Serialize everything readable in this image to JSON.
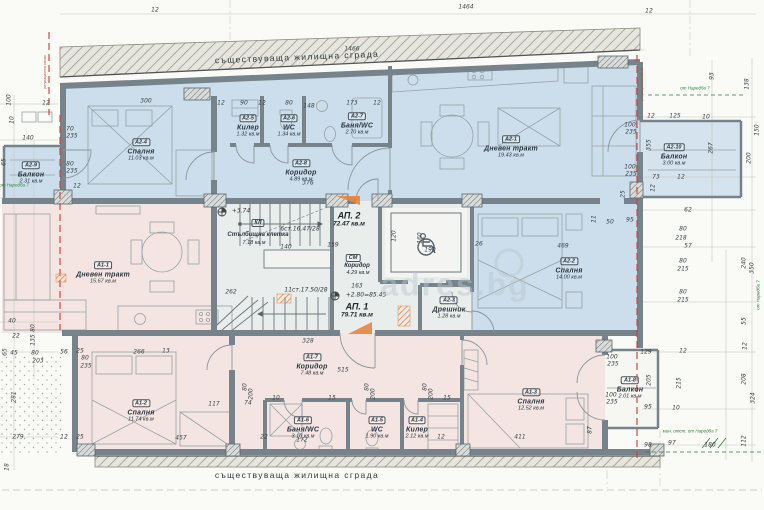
{
  "colors": {
    "ap2_fill": "#ccdeeb",
    "ap1_fill": "#f4e5e3",
    "common_fill": "#e9edec",
    "wall": "#76838a",
    "red": "#d23b2f",
    "green": "#2f7d3a",
    "orange": "#e8833f",
    "dim_text": "#3d4448",
    "paper": "#fafaf7"
  },
  "strips": {
    "top": "съществуваща жилищна сграда",
    "bottom": "съществуваща жилищна сграда"
  },
  "watermark": {
    "text": "adres.bg"
  },
  "apartments": [
    {
      "label": "АП. 2",
      "area": "72.47 кв.м",
      "x": 349,
      "y": 219
    },
    {
      "label": "АП. 1",
      "area": "79.71 кв.м",
      "x": 357,
      "y": 310
    }
  ],
  "rooms": [
    {
      "code": "А2-1",
      "name": "Дневен тракт",
      "area": "19.43 кв.м",
      "x": 511,
      "y": 143
    },
    {
      "code": "А2-2",
      "name": "Спалня",
      "area": "14.00 кв.м",
      "x": 569,
      "y": 265
    },
    {
      "code": "А2-3",
      "name": "Дрешник",
      "area": "1.28 кв.м",
      "x": 449,
      "y": 304
    },
    {
      "code": "А2-4",
      "name": "Спалня",
      "area": "11.03 кв.м",
      "x": 141,
      "y": 146
    },
    {
      "code": "А2-5",
      "name": "Килер",
      "area": "1.32 кв.м",
      "x": 248,
      "y": 122
    },
    {
      "code": "А2-6",
      "name": "WC",
      "area": "1.34 кв.м",
      "x": 289,
      "y": 122
    },
    {
      "code": "А2-7",
      "name": "Баня/WC",
      "area": "2.70 кв.м",
      "x": 357,
      "y": 120
    },
    {
      "code": "А2-8",
      "name": "Коридор",
      "area": "4.89 кв.м",
      "x": 301,
      "y": 167
    },
    {
      "code": "А2-9",
      "name": "Балкон",
      "area": "2.31 кв.м",
      "x": 31,
      "y": 169
    },
    {
      "code": "А2-10",
      "name": "Балкон",
      "area": "3.00 кв.м",
      "x": 674,
      "y": 151
    },
    {
      "code": "А1-1",
      "name": "Дневен тракт",
      "area": "15.67 кв.м",
      "x": 103,
      "y": 269
    },
    {
      "code": "А1-2",
      "name": "Спалня",
      "area": "11.74 кв.м",
      "x": 141,
      "y": 407
    },
    {
      "code": "А1-3",
      "name": "Спалня",
      "area": "12.52 кв.м",
      "x": 531,
      "y": 396
    },
    {
      "code": "А1-4",
      "name": "Килер",
      "area": "2.12 кв.м",
      "x": 417,
      "y": 424
    },
    {
      "code": "А1-5",
      "name": "WC",
      "area": "1.90 кв.м",
      "x": 377,
      "y": 424
    },
    {
      "code": "А1-6",
      "name": "Баня/WC",
      "area": "3.10 кв.м",
      "x": 303,
      "y": 424
    },
    {
      "code": "А1-7",
      "name": "Коридор",
      "area": "7.48 кв.м",
      "x": 312,
      "y": 361
    },
    {
      "code": "А1-8",
      "name": "Балкон",
      "area": "2.01 кв.м",
      "x": 630,
      "y": 384
    }
  ],
  "stairwell": {
    "code": "КЛ",
    "name": "Стълбищна клетка",
    "area": "7.18 кв.м",
    "flight_up": "6ст.16.47/28",
    "flight_down": "11ст.17.50/28",
    "level_landing": "+3.74"
  },
  "common_corridor": {
    "code": "СМ",
    "name": "Коридор",
    "area": "4.29 кв.м"
  },
  "levels": {
    "main": "+2.80=85.45"
  },
  "green_notes": [
    {
      "t": "от Наредба 7",
      "x": 695,
      "y": 88
    },
    {
      "t": "от Наредба 7",
      "x": 14,
      "y": 185
    },
    {
      "t": "мин. отст. от Наредба 7",
      "x": 690,
      "y": 431
    },
    {
      "t": "от Наредба 7",
      "x": 758,
      "y": 295,
      "r": -90
    }
  ],
  "red_notes": [
    {
      "t": "регулационна линия",
      "x": 45,
      "y": 72,
      "r": -90
    },
    {
      "t": "регулационна линия",
      "x": 642,
      "y": 84,
      "r": -90
    }
  ],
  "dimensions": [
    {
      "t": "12",
      "x": 155,
      "y": 10
    },
    {
      "t": "1464",
      "x": 466,
      "y": 7
    },
    {
      "t": "1466",
      "x": 352,
      "y": 49
    },
    {
      "t": "12",
      "x": 649,
      "y": 11
    },
    {
      "t": "300",
      "x": 146,
      "y": 101
    },
    {
      "t": "12",
      "x": 221,
      "y": 103
    },
    {
      "t": "90",
      "x": 244,
      "y": 103
    },
    {
      "t": "12",
      "x": 262,
      "y": 103
    },
    {
      "t": "80",
      "x": 289,
      "y": 103
    },
    {
      "t": "148",
      "x": 309,
      "y": 106
    },
    {
      "t": "173",
      "x": 352,
      "y": 103
    },
    {
      "t": "12",
      "x": 377,
      "y": 103
    },
    {
      "t": "100",
      "x": 9,
      "y": 100,
      "r": -90
    },
    {
      "t": "12",
      "x": 46,
      "y": 103
    },
    {
      "t": "10",
      "x": 12,
      "y": 120,
      "r": -90
    },
    {
      "t": "140",
      "x": 28,
      "y": 138
    },
    {
      "t": "65",
      "x": 4,
      "y": 162,
      "r": -90
    },
    {
      "t": "70",
      "x": 70,
      "y": 129
    },
    {
      "t": "235",
      "x": 72,
      "y": 136
    },
    {
      "t": "80",
      "x": 70,
      "y": 164
    },
    {
      "t": "235",
      "x": 72,
      "y": 171
    },
    {
      "t": "12",
      "x": 77,
      "y": 186
    },
    {
      "t": "40",
      "x": 12,
      "y": 321
    },
    {
      "t": "22",
      "x": 16,
      "y": 336
    },
    {
      "t": "80",
      "x": 33,
      "y": 328,
      "r": -90
    },
    {
      "t": "135",
      "x": 33,
      "y": 340,
      "r": -90
    },
    {
      "t": "65",
      "x": 5,
      "y": 352,
      "r": -90
    },
    {
      "t": "45",
      "x": 14,
      "y": 353
    },
    {
      "t": "80",
      "x": 35,
      "y": 353
    },
    {
      "t": "203",
      "x": 38,
      "y": 361
    },
    {
      "t": "56",
      "x": 64,
      "y": 352
    },
    {
      "t": "25",
      "x": 80,
      "y": 351
    },
    {
      "t": "80",
      "x": 85,
      "y": 358
    },
    {
      "t": "235",
      "x": 86,
      "y": 366
    },
    {
      "t": "266",
      "x": 139,
      "y": 352
    },
    {
      "t": "13",
      "x": 166,
      "y": 351
    },
    {
      "t": "281",
      "x": 14,
      "y": 397,
      "r": -90
    },
    {
      "t": "279",
      "x": 18,
      "y": 437
    },
    {
      "t": "18",
      "x": 7,
      "y": 467,
      "r": -90
    },
    {
      "t": "25",
      "x": 80,
      "y": 437
    },
    {
      "t": "12",
      "x": 64,
      "y": 437
    },
    {
      "t": "457",
      "x": 181,
      "y": 438
    },
    {
      "t": "117",
      "x": 214,
      "y": 404
    },
    {
      "t": "74",
      "x": 248,
      "y": 403
    },
    {
      "t": "22",
      "x": 264,
      "y": 437
    },
    {
      "t": "172",
      "x": 302,
      "y": 440
    },
    {
      "t": "80",
      "x": 245,
      "y": 387,
      "r": -90
    },
    {
      "t": "200",
      "x": 251,
      "y": 394,
      "r": -90
    },
    {
      "t": "10",
      "x": 276,
      "y": 398
    },
    {
      "t": "80",
      "x": 367,
      "y": 387,
      "r": -90
    },
    {
      "t": "200",
      "x": 373,
      "y": 394,
      "r": -90
    },
    {
      "t": "15",
      "x": 332,
      "y": 398
    },
    {
      "t": "80",
      "x": 425,
      "y": 387,
      "r": -90
    },
    {
      "t": "200",
      "x": 431,
      "y": 394,
      "r": -90
    },
    {
      "t": "15",
      "x": 447,
      "y": 398
    },
    {
      "t": "12",
      "x": 441,
      "y": 437
    },
    {
      "t": "376",
      "x": 308,
      "y": 183
    },
    {
      "t": "328",
      "x": 308,
      "y": 341
    },
    {
      "t": "515",
      "x": 343,
      "y": 370
    },
    {
      "t": "163",
      "x": 357,
      "y": 286
    },
    {
      "t": "159",
      "x": 333,
      "y": 245
    },
    {
      "t": "140",
      "x": 286,
      "y": 247
    },
    {
      "t": "262",
      "x": 231,
      "y": 292
    },
    {
      "t": "190",
      "x": 430,
      "y": 250
    },
    {
      "t": "160",
      "x": 420,
      "y": 238,
      "r": -90
    },
    {
      "t": "120",
      "x": 394,
      "y": 236,
      "r": -90
    },
    {
      "t": "26",
      "x": 479,
      "y": 244
    },
    {
      "t": "469",
      "x": 563,
      "y": 246
    },
    {
      "t": "411",
      "x": 520,
      "y": 437
    },
    {
      "t": "87",
      "x": 590,
      "y": 430,
      "r": -90
    },
    {
      "t": "93",
      "x": 712,
      "y": 76,
      "r": -90
    },
    {
      "t": "138",
      "x": 747,
      "y": 84,
      "r": -90
    },
    {
      "t": "12",
      "x": 651,
      "y": 116
    },
    {
      "t": "125",
      "x": 675,
      "y": 116
    },
    {
      "t": "10",
      "x": 706,
      "y": 117
    },
    {
      "t": "150",
      "x": 757,
      "y": 130,
      "r": -90
    },
    {
      "t": "100",
      "x": 630,
      "y": 125
    },
    {
      "t": "235",
      "x": 631,
      "y": 132
    },
    {
      "t": "355",
      "x": 649,
      "y": 145,
      "r": -90
    },
    {
      "t": "267",
      "x": 711,
      "y": 148,
      "r": -90
    },
    {
      "t": "200",
      "x": 749,
      "y": 158,
      "r": -90
    },
    {
      "t": "100",
      "x": 630,
      "y": 167
    },
    {
      "t": "235",
      "x": 631,
      "y": 174
    },
    {
      "t": "73",
      "x": 656,
      "y": 177
    },
    {
      "t": "12",
      "x": 681,
      "y": 177
    },
    {
      "t": "12",
      "x": 653,
      "y": 188,
      "r": -90
    },
    {
      "t": "25",
      "x": 623,
      "y": 194,
      "r": -90
    },
    {
      "t": "62",
      "x": 688,
      "y": 210
    },
    {
      "t": "95",
      "x": 630,
      "y": 220
    },
    {
      "t": "50",
      "x": 610,
      "y": 222
    },
    {
      "t": "11",
      "x": 594,
      "y": 219,
      "r": -90
    },
    {
      "t": "80",
      "x": 683,
      "y": 229
    },
    {
      "t": "218",
      "x": 681,
      "y": 238
    },
    {
      "t": "57",
      "x": 688,
      "y": 246
    },
    {
      "t": "80",
      "x": 683,
      "y": 261
    },
    {
      "t": "215",
      "x": 683,
      "y": 269
    },
    {
      "t": "240",
      "x": 744,
      "y": 263,
      "r": -90
    },
    {
      "t": "350",
      "x": 752,
      "y": 268,
      "r": -90
    },
    {
      "t": "80",
      "x": 683,
      "y": 292
    },
    {
      "t": "215",
      "x": 683,
      "y": 300
    },
    {
      "t": "55",
      "x": 744,
      "y": 321,
      "r": -90
    },
    {
      "t": "12",
      "x": 745,
      "y": 346,
      "r": -90
    },
    {
      "t": "129",
      "x": 646,
      "y": 352
    },
    {
      "t": "12",
      "x": 683,
      "y": 351
    },
    {
      "t": "205",
      "x": 649,
      "y": 380,
      "r": -90
    },
    {
      "t": "215",
      "x": 679,
      "y": 383,
      "r": -90
    },
    {
      "t": "208",
      "x": 744,
      "y": 379,
      "r": -90
    },
    {
      "t": "324",
      "x": 753,
      "y": 398,
      "r": -90
    },
    {
      "t": "100",
      "x": 612,
      "y": 357
    },
    {
      "t": "235",
      "x": 613,
      "y": 364
    },
    {
      "t": "100",
      "x": 611,
      "y": 395
    },
    {
      "t": "235",
      "x": 612,
      "y": 402
    },
    {
      "t": "95",
      "x": 648,
      "y": 407
    },
    {
      "t": "10",
      "x": 676,
      "y": 408
    },
    {
      "t": "98",
      "x": 648,
      "y": 445
    },
    {
      "t": "97",
      "x": 672,
      "y": 443
    },
    {
      "t": "180",
      "x": 710,
      "y": 445
    },
    {
      "t": "112",
      "x": 744,
      "y": 441,
      "r": -90
    }
  ]
}
